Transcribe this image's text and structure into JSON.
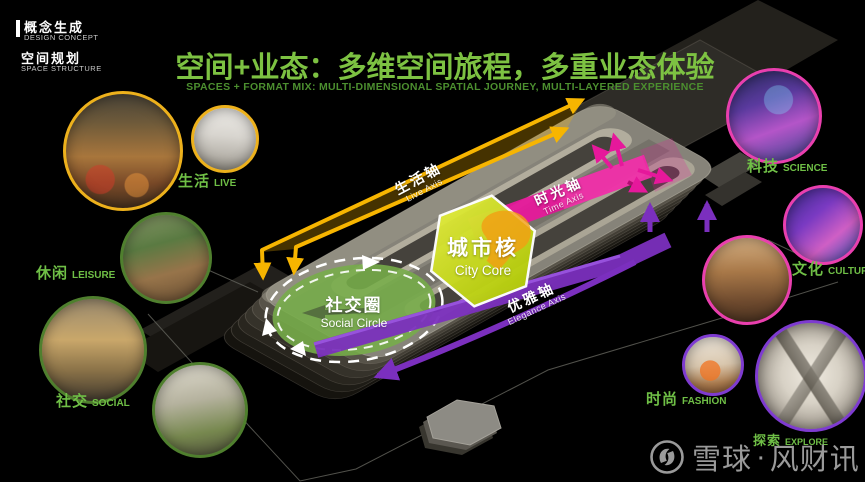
{
  "header": {
    "section1_zh": "概念生成",
    "section1_en": "DESIGN CONCEPT",
    "section2_zh": "空间规划",
    "section2_en": "SPACE STRUCTURE"
  },
  "title": {
    "zh": "空间+业态：多维空间旅程，多重业态体验",
    "en": "SPACES + FORMAT MIX: MULTI-DIMENSIONAL SPATIAL JOURNEY, MULTI-LAYERED EXPERIENCE",
    "title_color": "#7dc242",
    "subtitle_color": "#4c8f2f"
  },
  "categories": {
    "life": {
      "zh": "生活",
      "en": "LIVE",
      "ring_color": "#edb11c"
    },
    "leisure": {
      "zh": "休闲",
      "en": "LEISURE",
      "ring_color": "#4f7f2e"
    },
    "social": {
      "zh": "社交",
      "en": "SOCIAL",
      "ring_color": "#4f7f2e"
    },
    "science": {
      "zh": "科技",
      "en": "SCIENCE",
      "ring_color": "#e93fae"
    },
    "culture": {
      "zh": "文化",
      "en": "CULTURE",
      "ring_color": "#e93fae"
    },
    "fashion": {
      "zh": "时尚",
      "en": "FASHION",
      "ring_color": "#7e3bd0"
    },
    "explore": {
      "zh": "探索",
      "en": "EXPLORE"
    }
  },
  "diagram": {
    "axis_live": {
      "zh": "生活轴",
      "en": "Live Axis",
      "color": "#f7b500"
    },
    "axis_time": {
      "zh": "时光轴",
      "en": "Time Axis",
      "color": "#e6189b"
    },
    "axis_elegance": {
      "zh": "优雅轴",
      "en": "Elegance Axis",
      "color": "#7b2fbe"
    },
    "city_core": {
      "zh": "城市核",
      "en": "City Core",
      "color": "#c3d600"
    },
    "social_circle": {
      "zh": "社交圈",
      "en": "Social Circle",
      "color": "#76ad49"
    },
    "label_color": "#6fbf46"
  },
  "watermark": {
    "brand1": "雪球",
    "separator": "·",
    "brand2": "风财讯"
  }
}
